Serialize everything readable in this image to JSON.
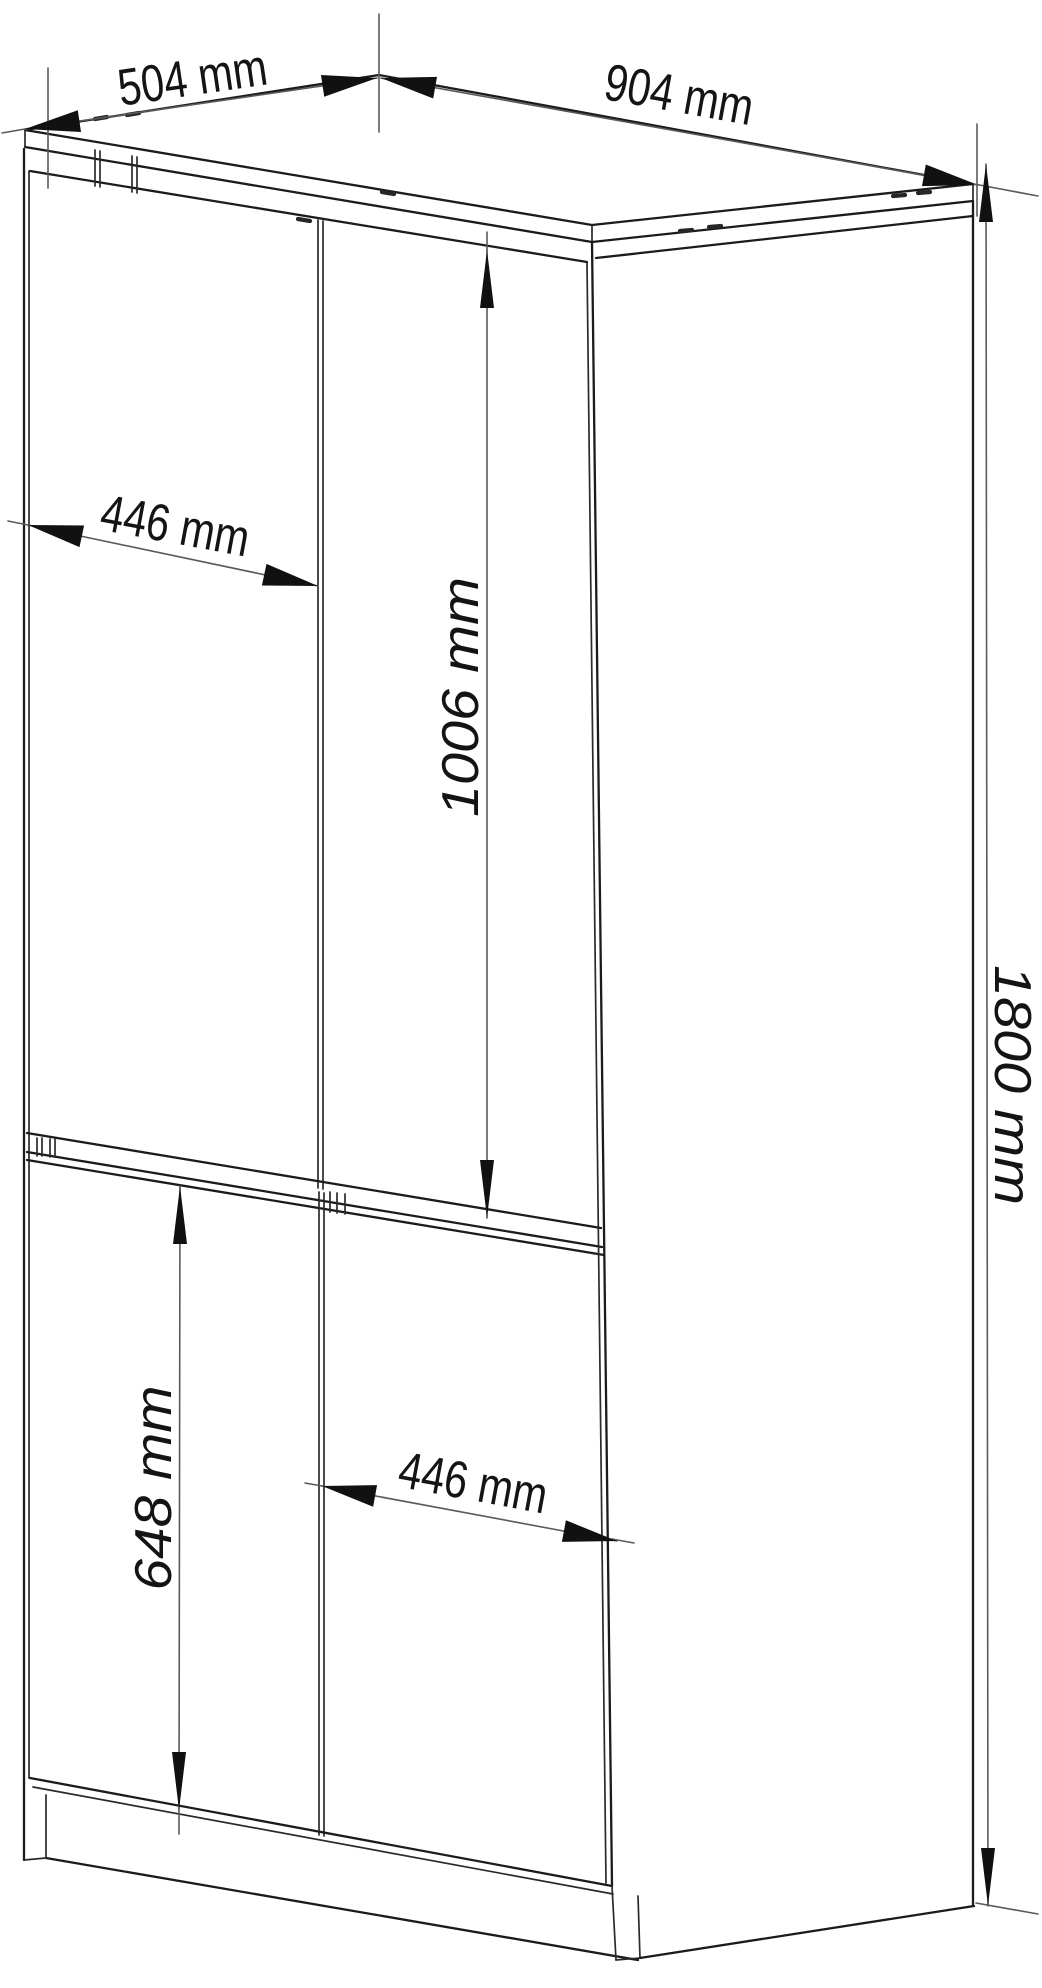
{
  "colors": {
    "background": "#ffffff",
    "cabinet_line": "#1b1b1b",
    "dimension_line": "#5a5a5a",
    "arrow": "#111111",
    "label_text": "#141414"
  },
  "labels": {
    "depth": "504 mm",
    "width": "904 mm",
    "upper_door_width": "446 mm",
    "upper_door_height": "1006 mm",
    "overall_height": "1800 mm",
    "lower_door_height": "648 mm",
    "lower_door_width": "446 mm"
  }
}
